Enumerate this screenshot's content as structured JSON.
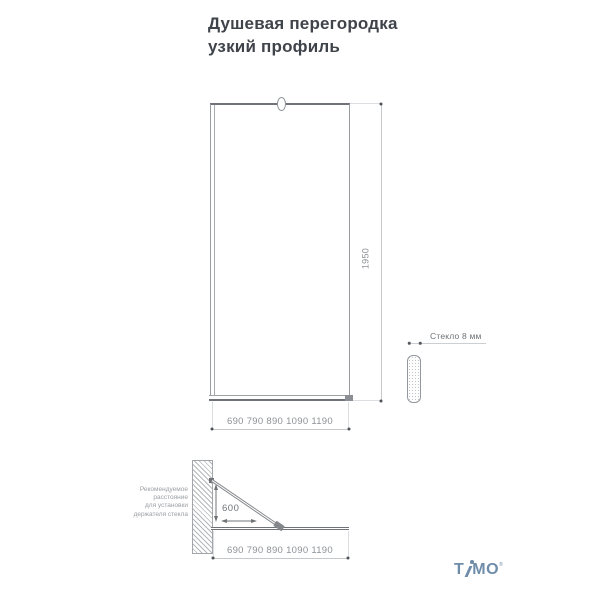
{
  "title": {
    "line1": "Душевая перегородка",
    "line2": "узкий профиль"
  },
  "front_view": {
    "height_label": "1950",
    "width_label": "690 790 890 1090 1190"
  },
  "glass_section": {
    "label": "Стекло 8 мм"
  },
  "side_view": {
    "distance_label": "600",
    "width_label": "690 790 890 1090 1190",
    "note": [
      "Рекомендуемое",
      "расстояние",
      "для установки",
      "держателя стекла"
    ]
  },
  "logo": {
    "t": "T",
    "mo": "MO",
    "reg": "®"
  },
  "colors": {
    "accent_logo": "#6f8ca9",
    "drawing_line": "#989ca1",
    "dark_line": "#6e7277",
    "dimension_line": "#c6c9cc",
    "dimension_text": "#8d9196",
    "title_text": "#3f434a"
  }
}
